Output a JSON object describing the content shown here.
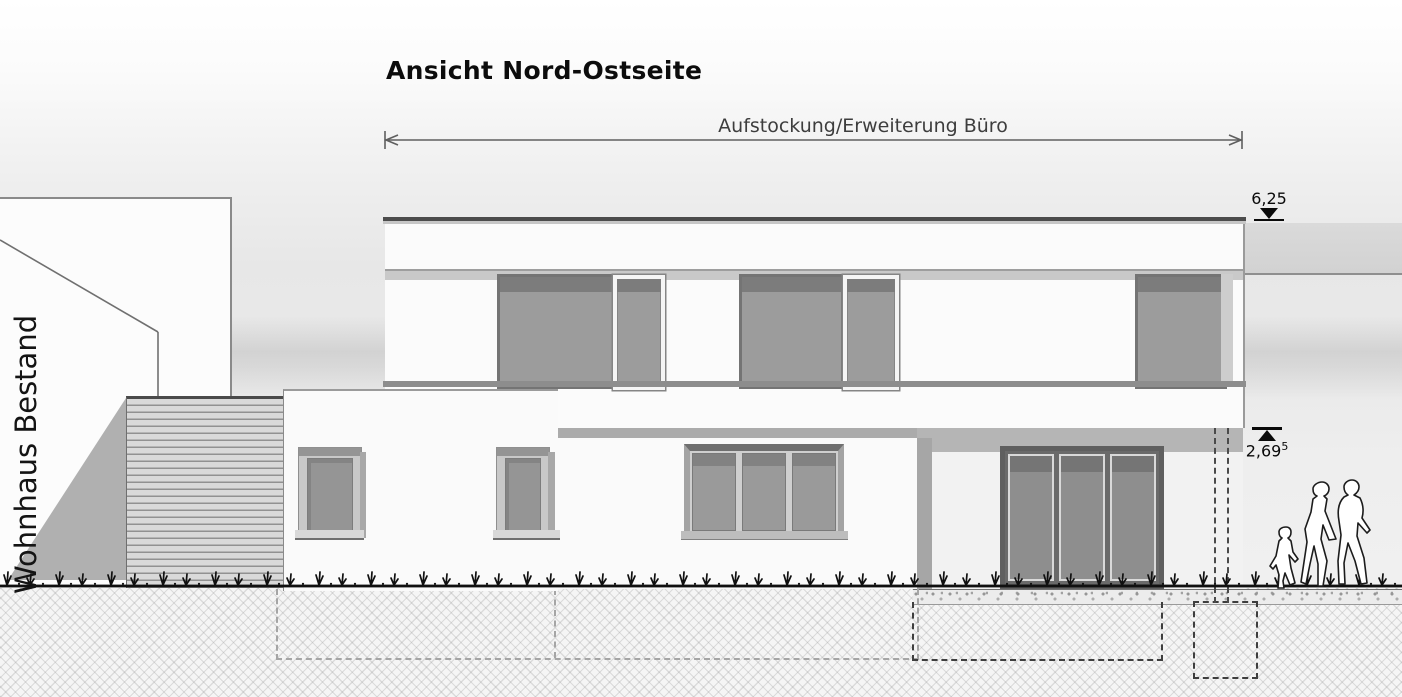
{
  "drawing": {
    "title": "Ansicht Nord-Ostseite",
    "dimension": {
      "label": "Aufstockung/Erweiterung Büro"
    },
    "existing_building_label": "Wohnhaus Bestand",
    "levels": {
      "roof": {
        "value": "6,25"
      },
      "upper_floor": {
        "value": "2,69",
        "sup": "5"
      }
    },
    "colors": {
      "wall": "#fbfbfb",
      "glass": "#9c9c9c",
      "glass_shade": "#7c7c7c",
      "frame_dark": "#747474",
      "frame_light": "#f5f5f5",
      "soffit": "#ababab",
      "slats": "#d9d9d9",
      "shadow": "#b0b0b0",
      "ground_line": "#101010",
      "foundation_dash": "#3e3e3e"
    }
  }
}
